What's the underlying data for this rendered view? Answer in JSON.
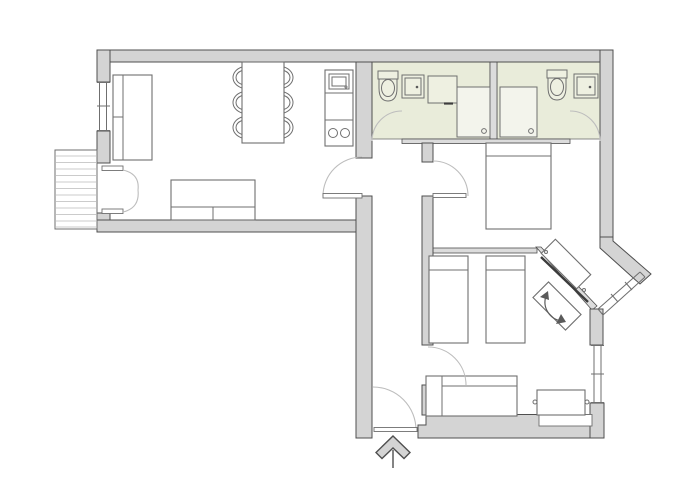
{
  "colors": {
    "wall_fill": "#d4d4d4",
    "wall_stroke": "#4f4f4f",
    "thinwall_fill": "#dcdcdc",
    "bath_floor": "#e9ecda",
    "fixture_fill": "#eef0e1",
    "shower_fill": "#f3f4ec",
    "furn_stroke": "#6f6f6f",
    "arc_stroke": "#bdbdbd",
    "hatch": "#cbcbcb",
    "accent_dark": "#3c3c3c"
  },
  "plan": {
    "type": "apartment-floor-plan",
    "rooms": [
      {
        "name": "living-room-with-kitchen",
        "items": [
          "sofa-bed",
          "dining-table",
          "six-chairs",
          "kitchen-unit",
          "sofa"
        ]
      },
      {
        "name": "balcony",
        "items": [
          "decking",
          "french-double-door"
        ]
      },
      {
        "name": "bathroom-1",
        "items": [
          "toilet",
          "washbasin",
          "cabinet",
          "shower"
        ]
      },
      {
        "name": "bathroom-2",
        "items": [
          "shower",
          "toilet",
          "washbasin"
        ]
      },
      {
        "name": "double-bedroom",
        "items": [
          "double-bed",
          "diagonal-bay-window"
        ]
      },
      {
        "name": "twin-bedroom",
        "items": [
          "single-bed",
          "single-bed",
          "bench-sofa",
          "side-table",
          "pivot-unit",
          "window"
        ]
      },
      {
        "name": "hallway",
        "items": [
          "entrance-door",
          "entrance-arrow"
        ]
      }
    ],
    "windows": 4,
    "entrance": "bottom-center"
  }
}
